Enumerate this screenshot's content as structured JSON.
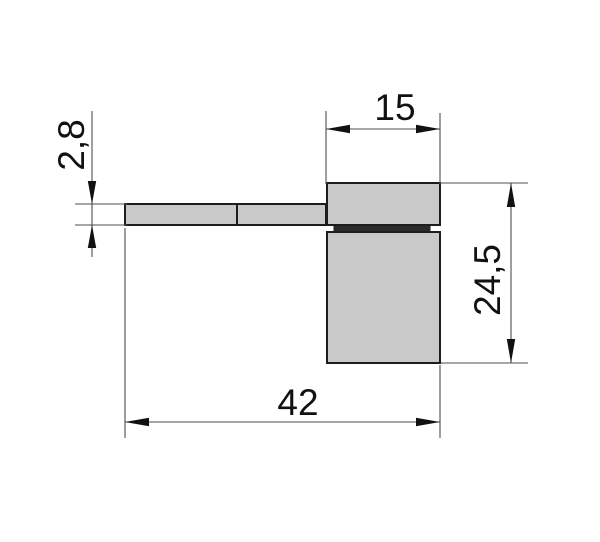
{
  "drawing": {
    "labels": {
      "bar_thickness": "2,8",
      "block_width": "15",
      "block_height": "24,5",
      "total_length": "42"
    },
    "values_mm": {
      "bar_thickness": 2.8,
      "block_width": 15,
      "block_height": 24.5,
      "total_length": 42
    },
    "colors": {
      "background": "#ffffff",
      "part_fill": "#c9c9c9",
      "part_outline": "#1d1d1d",
      "gasket_fill": "#2b2b2b",
      "dimension_line": "#4f4f4f",
      "arrow": "#111111",
      "text": "#111111"
    }
  }
}
